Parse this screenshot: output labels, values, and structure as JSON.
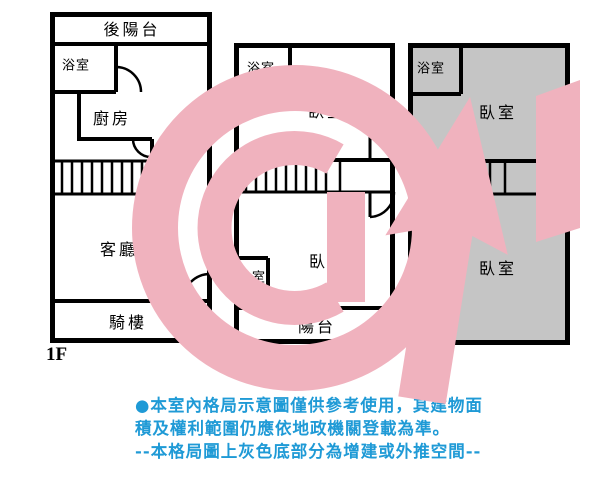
{
  "title": "室內格局示意圖",
  "colors": {
    "wall": "#000000",
    "extension_gray": "#c5c5c5",
    "disclaimer_blue": "#1f9ad6",
    "watermark_pink": "#f0b2be"
  },
  "watermark": {
    "name": "agency-logo-g-arrow"
  },
  "floors": [
    {
      "label": "1F",
      "rooms": {
        "rear_balcony": "後陽台",
        "bathroom": "浴室",
        "kitchen": "廚房",
        "living_room": "客廳",
        "arcade": "騎樓"
      }
    },
    {
      "label": "2F",
      "rooms": {
        "bathroom_top": "浴室",
        "bedroom_top": "臥室",
        "bathroom_bottom": "浴室",
        "bedroom_bottom": "臥室",
        "balcony": "陽台"
      }
    },
    {
      "label": "3F",
      "rooms": {
        "bathroom_top": "浴室",
        "bedroom_top": "臥室",
        "bedroom_bottom": "臥室",
        "bathroom_bottom": "浴室"
      }
    }
  ],
  "disclaimer": {
    "line1": "●本室內格局示意圖僅供參考使用，其建物面",
    "line2": "積及權利範圍仍應依地政機關登載為準。",
    "line3": "--本格局圖上灰色底部分為增建或外推空間--"
  }
}
